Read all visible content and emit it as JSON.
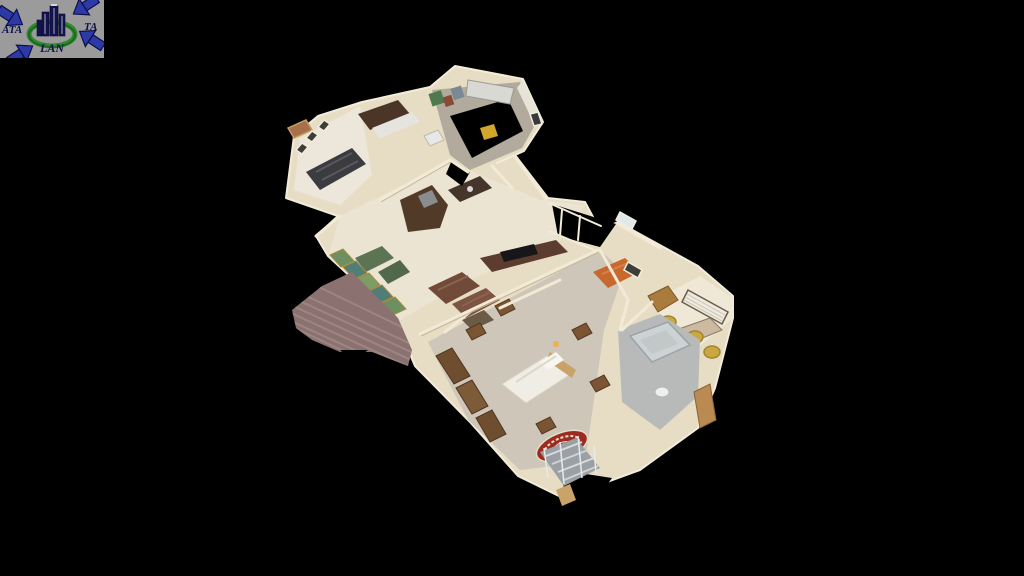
{
  "window": {
    "background": "#000000"
  },
  "logo": {
    "left": "ATA",
    "right": "TA",
    "bottom": "LAN",
    "background": "#9b9b9b",
    "arrow_color": "#2c3aa6",
    "arrow_outline": "#0e0e4e",
    "ring_color": "#2e8b2e",
    "building_color": "#14144c",
    "text_color": "#10104e"
  },
  "model": {
    "palette": {
      "wall": "#e7ddc4",
      "wall_line": "#f2ead6",
      "floor_tile": "#ece4d2",
      "carpet": "#cdc6b9",
      "garage_floor": "#b2aa9c",
      "bath_tile": "#b7bab9",
      "office_floor": "#efe8d6",
      "deck_wood": "#8b7270",
      "deck_stripe": "#9d8582",
      "door_wood": "#7a5433",
      "cabinet_dark": "#4a3527",
      "sofa_leather": "#714a3a",
      "sofa_orange": "#c7692f",
      "chair_yellow": "#c9a741",
      "rug_red": "#9e2b20",
      "glass_green": "#6e8f62",
      "glass_teal": "#4f7d78",
      "bed_white": "#f0ede5",
      "shower_glass": "#cfd6d8",
      "recliner_gray": "#3b3b40"
    }
  }
}
